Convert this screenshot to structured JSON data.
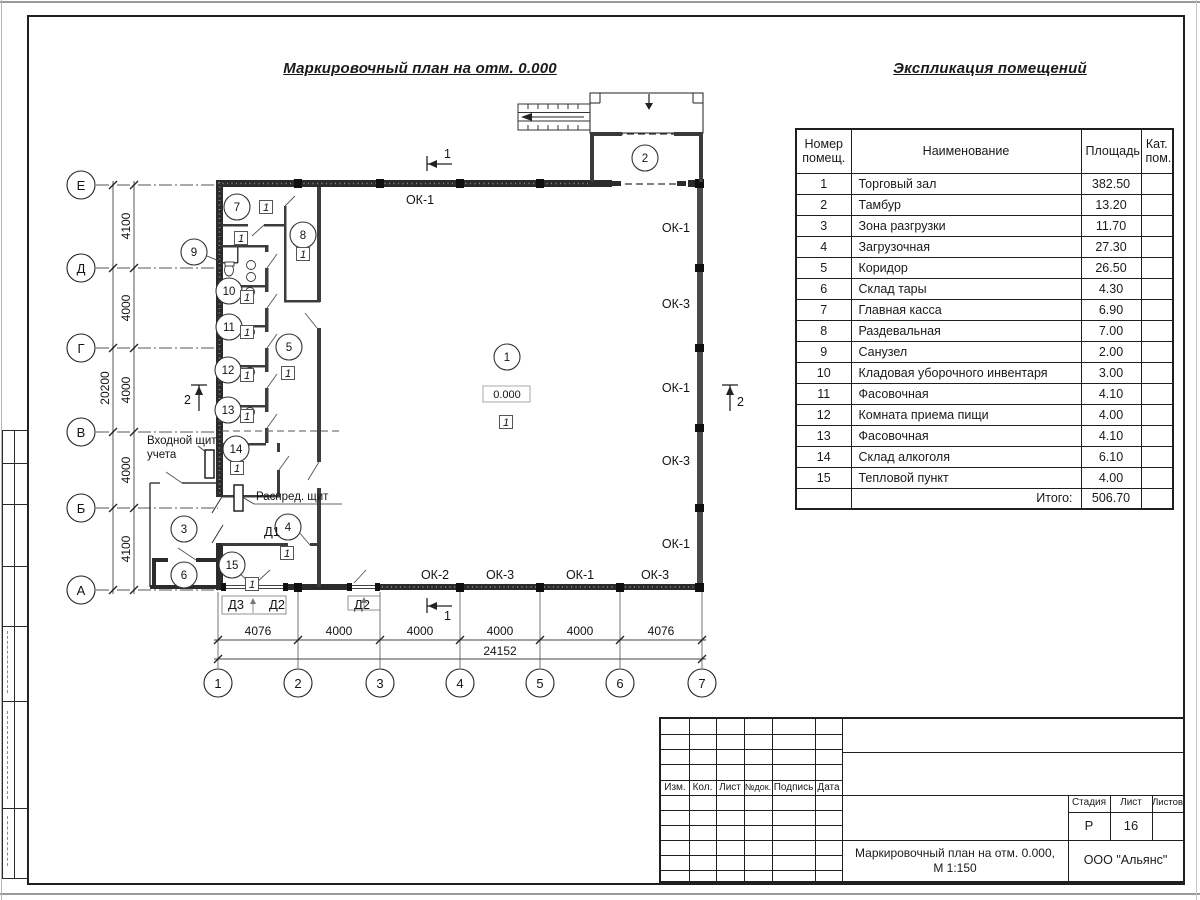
{
  "sheet": {
    "plan_title": "Маркировочный план на отм. 0.000",
    "explication_title": "Экспликация помещений"
  },
  "explication": {
    "col_num": "Номер помещ.",
    "col_name": "Наименование",
    "col_area": "Площадь",
    "col_cat": "Кат. пом.",
    "rows": [
      {
        "num": "1",
        "name": "Торговый зал",
        "area": "382.50"
      },
      {
        "num": "2",
        "name": "Тамбур",
        "area": "13.20"
      },
      {
        "num": "3",
        "name": "Зона разгрузки",
        "area": "11.70"
      },
      {
        "num": "4",
        "name": "Загрузочная",
        "area": "27.30"
      },
      {
        "num": "5",
        "name": "Коридор",
        "area": "26.50"
      },
      {
        "num": "6",
        "name": "Склад тары",
        "area": "4.30"
      },
      {
        "num": "7",
        "name": "Главная касса",
        "area": "6.90"
      },
      {
        "num": "8",
        "name": "Раздевальная",
        "area": "7.00"
      },
      {
        "num": "9",
        "name": "Санузел",
        "area": "2.00"
      },
      {
        "num": "10",
        "name": "Кладовая уборочного инвентаря",
        "area": "3.00"
      },
      {
        "num": "11",
        "name": "Фасовочная",
        "area": "4.10"
      },
      {
        "num": "12",
        "name": "Комната приема пищи",
        "area": "4.00"
      },
      {
        "num": "13",
        "name": "Фасовочная",
        "area": "4.10"
      },
      {
        "num": "14",
        "name": "Склад алкоголя",
        "area": "6.10"
      },
      {
        "num": "15",
        "name": "Тепловой пункт",
        "area": "4.00"
      }
    ],
    "total_label": "Итого:",
    "total_value": "506.70"
  },
  "plan": {
    "elevation": "0.000",
    "floor_marker": "1",
    "rooms": {
      "r1": "1",
      "r2": "2",
      "r3": "3",
      "r4": "4",
      "r5": "5",
      "r6": "6",
      "r7": "7",
      "r8": "8",
      "r9": "9",
      "r10": "10",
      "r11": "11",
      "r12": "12",
      "r13": "13",
      "r14": "14",
      "r15": "15"
    },
    "axes_rows": [
      "Е",
      "Д",
      "Г",
      "В",
      "Б",
      "А"
    ],
    "axes_cols": [
      "1",
      "2",
      "3",
      "4",
      "5",
      "6",
      "7"
    ],
    "dims_v": [
      "4100",
      "4000",
      "4000",
      "4000",
      "4100"
    ],
    "dim_v_total": "20200",
    "dims_h": [
      "4076",
      "4000",
      "4000",
      "4000",
      "4000",
      "4076"
    ],
    "dim_h_total": "24152",
    "window_top": "ОК-1",
    "windows_right": [
      "ОК-1",
      "ОК-3",
      "ОК-1",
      "ОК-3",
      "ОК-1"
    ],
    "windows_bottom": [
      "ОК-2",
      "ОК-3",
      "ОК-1",
      "ОК-3"
    ],
    "doors": {
      "d1": "Д1",
      "d3": "Д3",
      "d2a": "Д2",
      "d2b": "Д2"
    },
    "sections": {
      "s1": "1",
      "s2": "2"
    },
    "entry_panel_line1": "Входной щит",
    "entry_panel_line2": "учета",
    "dist_panel": "Распред. щит"
  },
  "title_block": {
    "cols": [
      "Изм.",
      "Кол.",
      "Лист",
      "№док.",
      "Подпись",
      "Дата"
    ],
    "stage_label": "Стадия",
    "sheet_label": "Лист",
    "sheets_label": "Листов",
    "stage": "Р",
    "sheet_num": "16",
    "doc_title_line1": "Маркировочный план на отм. 0.000,",
    "doc_title_line2": "М 1:150",
    "company": "ООО \"Альянс\""
  }
}
